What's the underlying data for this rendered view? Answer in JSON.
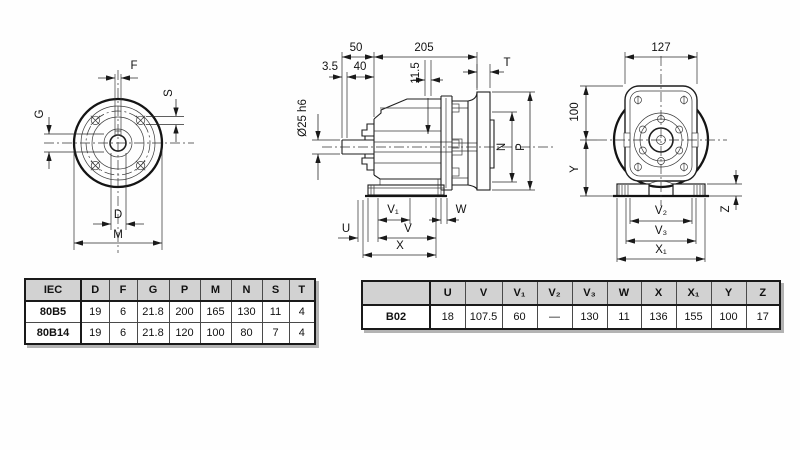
{
  "drawing": {
    "front_view": {
      "dim_f": "F",
      "dim_s": "S",
      "dim_g": "G",
      "dim_d": "D",
      "dim_m": "M"
    },
    "side_view": {
      "dim_50": "50",
      "dim_205": "205",
      "dim_3_5": "3.5",
      "dim_40": "40",
      "dim_11_5": "11.5",
      "dim_t": "T",
      "dim_shaft": "Ø25 h6",
      "dim_n": "N",
      "dim_p": "P",
      "dim_u": "U",
      "dim_v": "V",
      "dim_v1": "V₁",
      "dim_w": "W",
      "dim_x": "X"
    },
    "rear_view": {
      "dim_127": "127",
      "dim_100": "100",
      "dim_y": "Y",
      "dim_z": "Z",
      "dim_v2": "V₂",
      "dim_v3": "V₃",
      "dim_x1": "X₁"
    }
  },
  "tables": {
    "iec": {
      "headers": [
        "IEC",
        "D",
        "F",
        "G",
        "P",
        "M",
        "N",
        "S",
        "T"
      ],
      "rows": [
        [
          "80B5",
          "19",
          "6",
          "21.8",
          "200",
          "165",
          "130",
          "11",
          "4"
        ],
        [
          "80B14",
          "19",
          "6",
          "21.8",
          "120",
          "100",
          "80",
          "7",
          "4"
        ]
      ]
    },
    "b02": {
      "headers": [
        "",
        "U",
        "V",
        "V₁",
        "V₂",
        "V₃",
        "W",
        "X",
        "X₁",
        "Y",
        "Z"
      ],
      "rows": [
        [
          "B02",
          "18",
          "107.5",
          "60",
          "—",
          "130",
          "11",
          "136",
          "155",
          "100",
          "17"
        ]
      ]
    }
  },
  "colors": {
    "background": "#ffffff",
    "line": "#1e1e1e",
    "table_header_bg": "#d2d2d2",
    "table_border": "#1a1a1a",
    "shadow": "#b3b3b3"
  }
}
